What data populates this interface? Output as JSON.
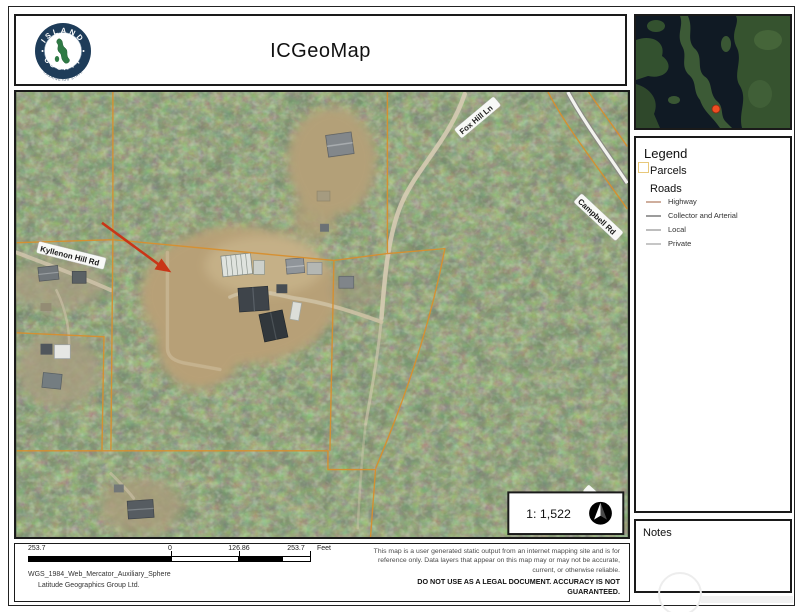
{
  "page": {
    "title": "ICGeoMap"
  },
  "logo": {
    "arc_top": "ISLAND",
    "arc_bottom": "COUNTY",
    "sub": "WASHINGTON STATE"
  },
  "legend": {
    "title": "Legend",
    "parcels": {
      "label": "Parcels",
      "swatch_color": "#e8c87a"
    },
    "roads": {
      "label": "Roads",
      "types": [
        {
          "label": "Highway",
          "color": "#cfae9d"
        },
        {
          "label": "Collector and Arterial",
          "color": "#9c9c9c"
        },
        {
          "label": "Local",
          "color": "#bdbdbd"
        },
        {
          "label": "Private",
          "color": "#c6c6c6"
        }
      ]
    }
  },
  "notes": {
    "title": "Notes"
  },
  "map": {
    "road_labels": [
      {
        "text": "Kyllenon Hill Rd"
      },
      {
        "text": "Fox Hill Ln"
      },
      {
        "text": "Campbell Rd"
      }
    ],
    "scale_ratio": "1: 1,522",
    "parcel_line_color": "#d78f2e",
    "annotation_arrow_color": "#c93517"
  },
  "footer": {
    "scalebar": {
      "far_left": "253.7",
      "zero": "0",
      "mid": "126.86",
      "right": "253.7",
      "unit": "Feet"
    },
    "projection": "WGS_1984_Web_Mercator_Auxiliary_Sphere",
    "credit": "Latitude Geographics Group Ltd.",
    "disclaimer": {
      "line1": "This map is a user generated static output from an internet mapping site and is for",
      "line2": "reference only. Data layers that appear on this map may or may not be accurate,",
      "line3": "current, or otherwise reliable.",
      "line4": "DO NOT USE AS A LEGAL DOCUMENT. ACCURACY IS NOT GUARANTEED."
    }
  }
}
